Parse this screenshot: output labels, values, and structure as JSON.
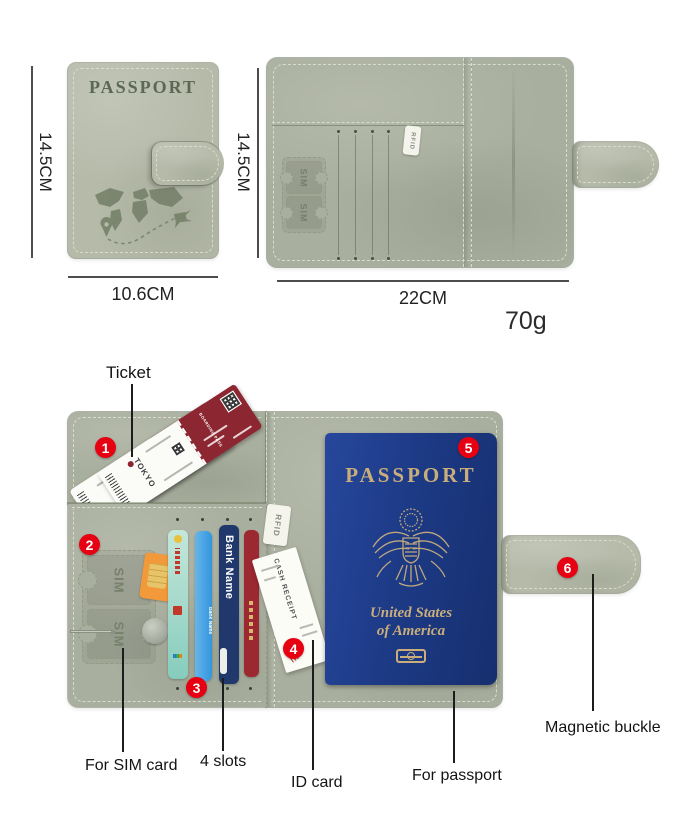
{
  "colors": {
    "leather": "#b5baa9",
    "leather_interior": "#a9af9e",
    "emboss": "#76816a",
    "annotation_red": "#e60012",
    "passport_navy": "#1d3a86",
    "passport_gold": "#c9ae7c",
    "ticket_maroon": "#8c2630",
    "card_teal": "#86ccbd",
    "card_blue": "#3396dd",
    "card_navy": "#20386b",
    "card_red": "#9c2831",
    "sim_orange": "#f2993b"
  },
  "shared": {
    "sim": "SIM",
    "rfid": "RFID",
    "bank": "Bank Name"
  },
  "top_left": {
    "cover_title": "PASSPORT",
    "height": "14.5CM",
    "width": "10.6CM"
  },
  "top_right": {
    "height": "14.5CM",
    "width": "22CM",
    "weight": "70g"
  },
  "bottom": {
    "ticket": {
      "header": "BOARDING PASS",
      "destination": "TOKYO"
    },
    "receipt": "CASH RECEIPT",
    "passport": {
      "title": "PASSPORT",
      "line1": "United States",
      "line2": "of America"
    },
    "annotations": [
      {
        "num": "1",
        "label": "Ticket"
      },
      {
        "num": "2",
        "label": "For SIM card"
      },
      {
        "num": "3",
        "label": "4 slots"
      },
      {
        "num": "4",
        "label": "ID card"
      },
      {
        "num": "5",
        "label": "For passport"
      },
      {
        "num": "6",
        "label": "Magnetic buckle"
      }
    ]
  }
}
